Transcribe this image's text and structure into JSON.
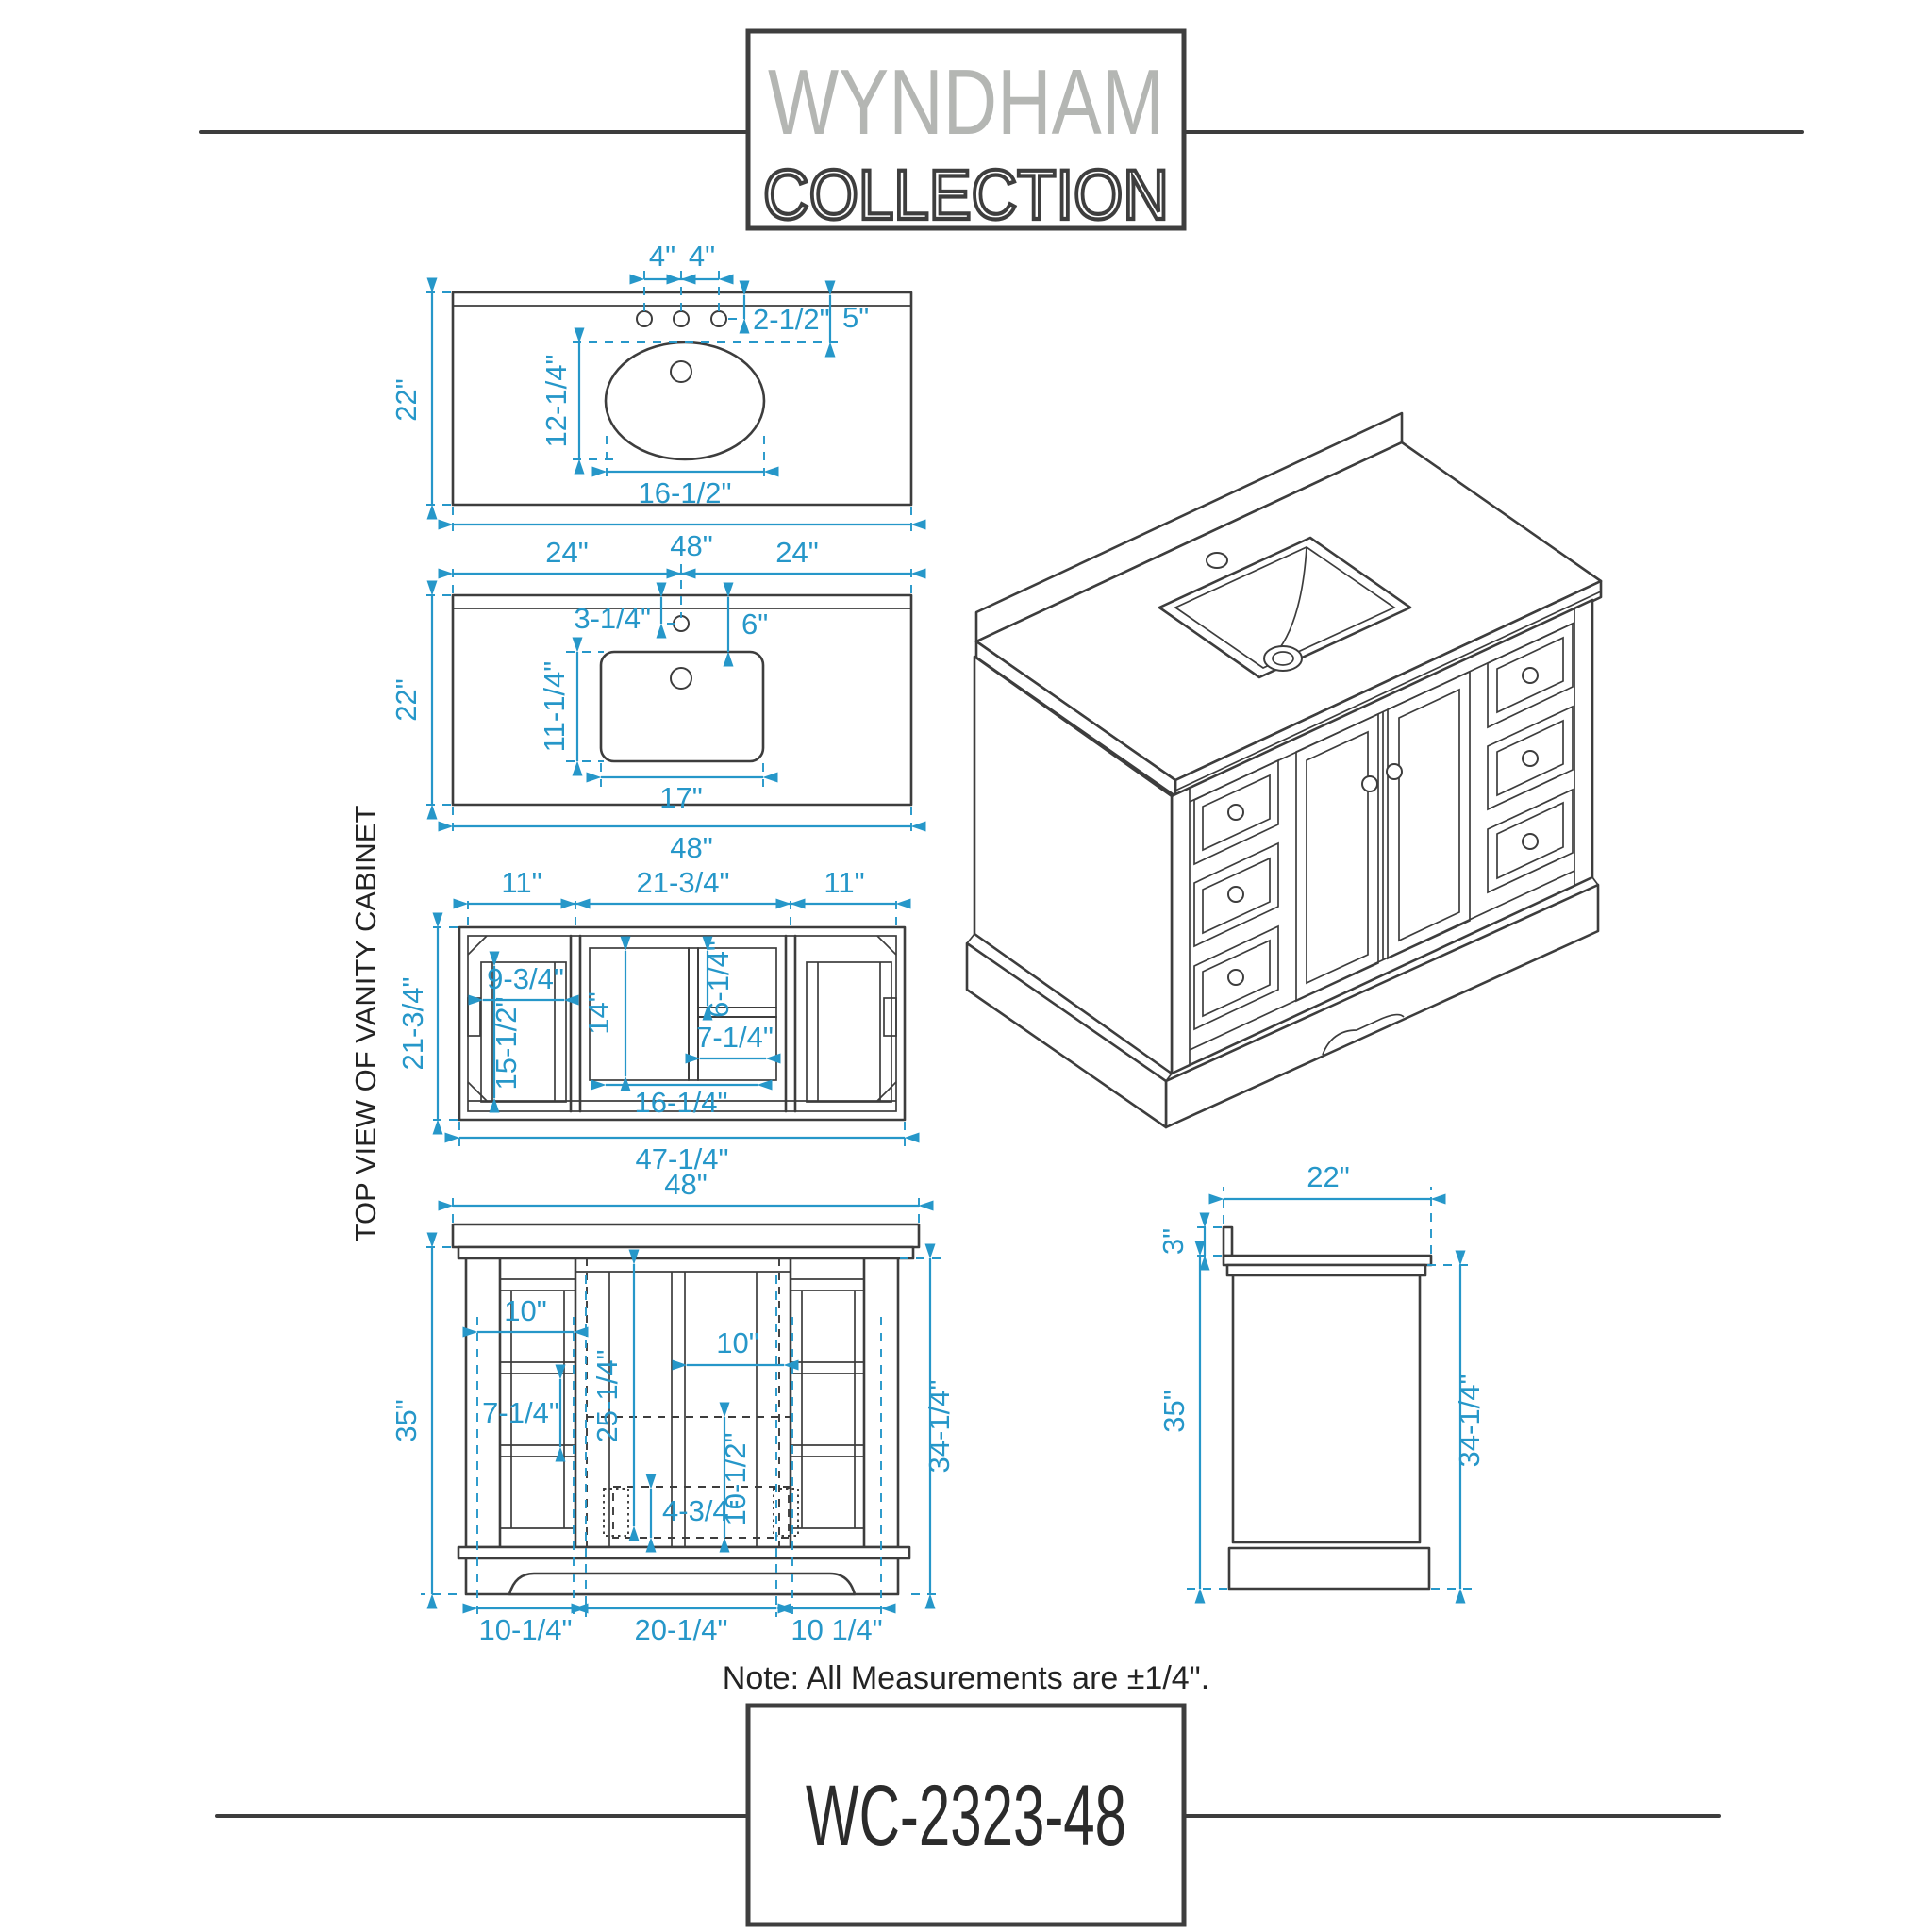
{
  "logo": {
    "name": "WYNDHAM",
    "sub": "COLLECTION"
  },
  "footer": {
    "note": "Note: All Measurements are ±1/4\".",
    "model": "WC-2323-48"
  },
  "views": {
    "counter_oval": {
      "spacing_l": "4\"",
      "spacing_r": "4\"",
      "hole_offset": "2-1/2\"",
      "sink_offset": "5\"",
      "sink_depth": "12-1/4\"",
      "sink_width": "16-1/2\"",
      "depth": "22\"",
      "width": "48\""
    },
    "counter_rect": {
      "half_l": "24\"",
      "half_r": "24\"",
      "hole_offset": "3-1/4\"",
      "sink_offset": "6\"",
      "sink_depth": "11-1/4\"",
      "sink_width": "17\"",
      "depth": "22\"",
      "width": "48\""
    },
    "cabinet_top": {
      "label": "TOP VIEW OF VANITY CABINET",
      "sec_l": "11\"",
      "sec_c": "21-3/4\"",
      "sec_r": "11\"",
      "depth": "21-3/4\"",
      "drawer_w": "9-3/4\"",
      "drawer_d": "15-1/2\"",
      "center_d": "14\"",
      "shelf_h": "6-1/4\"",
      "shelf_w": "7-1/4\"",
      "center_w": "16-1/4\"",
      "width": "47-1/4\""
    },
    "front": {
      "width": "48\"",
      "height": "35\"",
      "cab_height": "34-1/4\"",
      "drawer_l": "10\"",
      "drawer_h": "7-1/4\"",
      "door_h": "25-1/4\"",
      "drawer_r": "10\"",
      "toe": "10-1/2\"",
      "base_h": "4-3/4\"",
      "bot_l": "10-1/4\"",
      "bot_c": "20-1/4\"",
      "bot_r": "10 1/4\""
    },
    "side": {
      "depth": "22\"",
      "splash": "3\"",
      "height": "35\"",
      "cab_height": "34-1/4\""
    }
  }
}
